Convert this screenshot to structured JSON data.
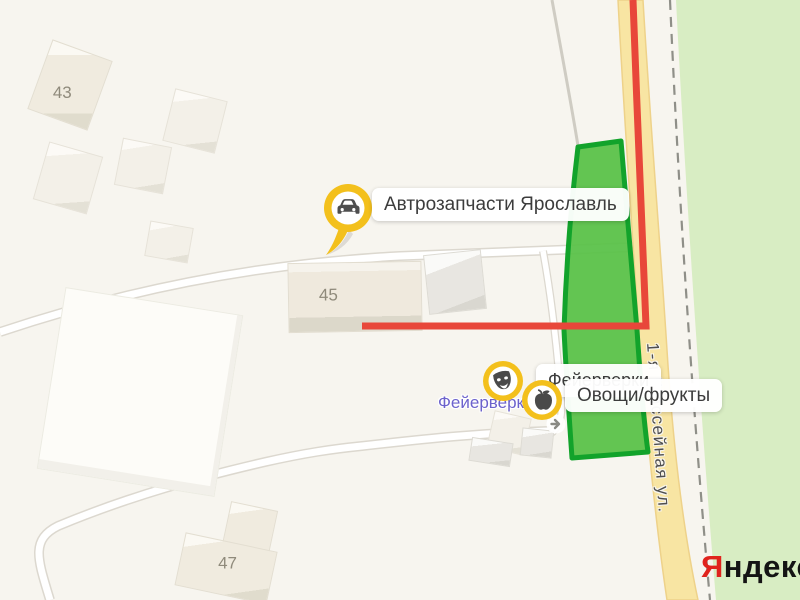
{
  "app": "yandex-map-fragment",
  "street": {
    "name": "1-я Шоссейная ул."
  },
  "buildings": {
    "b43": "43",
    "b45": "45",
    "b47": "47"
  },
  "pois": {
    "auto": {
      "label": "Автрозапчасти Ярославль",
      "icon": "car-pin"
    },
    "fireworks": {
      "label": "Фейерверки",
      "icon": "theater-masks"
    },
    "produce": {
      "label": "Овощи/фрукты",
      "icon": "apple"
    },
    "fireworks_street_text": "Фейерверки"
  },
  "logo": {
    "ya": "Я",
    "rest": "ндекс"
  },
  "colors": {
    "background": "#f7f5ef",
    "vegetation": "#d8edc3",
    "road_yellow": "#f8e5a3",
    "route_red": "#e8473a",
    "lot_fill": "#57c146",
    "lot_border": "#12a32b",
    "pin_yellow": "#f3c01c",
    "poi_text_blue": "#6c62cc",
    "logo_red": "#e0231d"
  }
}
